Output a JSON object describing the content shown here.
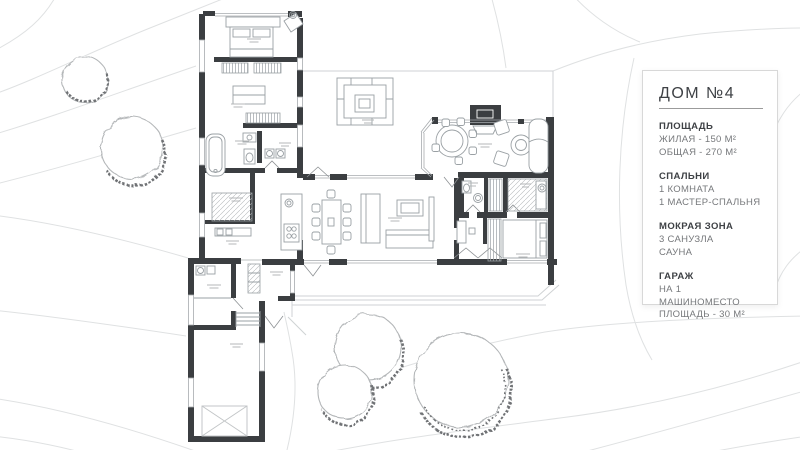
{
  "info_panel": {
    "title": "ДОМ №4",
    "sections": [
      {
        "heading": "ПЛОЩАДЬ",
        "lines": [
          "ЖИЛАЯ - 150 М²",
          "ОБЩАЯ - 270 М²"
        ]
      },
      {
        "heading": "СПАЛЬНИ",
        "lines": [
          "1 КОМНАТА",
          "1 МАСТЕР-СПАЛЬНЯ"
        ]
      },
      {
        "heading": "МОКРАЯ ЗОНА",
        "lines": [
          "3 САНУЗЛА",
          "САУНА"
        ]
      },
      {
        "heading": "ГАРАЖ",
        "lines": [
          "НА 1 МАШИНОМЕСТО",
          "ПЛОЩАДЬ - 30 М²"
        ]
      }
    ]
  },
  "colors": {
    "wall": "#3b3e41",
    "furniture": "#9aa0a4",
    "contour": "#dfe1e2",
    "tree_outline": "#b3b6b8",
    "tree_shade": "#6f7275",
    "panel_border": "#d8d8d8",
    "text_primary": "#3e4145",
    "text_secondary": "#76787b"
  }
}
